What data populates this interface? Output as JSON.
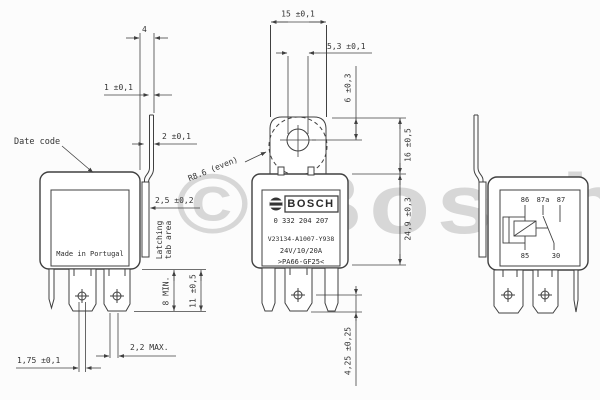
{
  "watermark": "© Bosch",
  "views": {
    "left": {
      "made_in": "Made in Portugal",
      "dims": {
        "tab_width": "4",
        "tab_thickness": "1 ±0,1",
        "tab_step": "2 ±0,1",
        "date_code_label": "Date code",
        "latch_depth": "2,5 ±0,2",
        "latching_line1": "Latching",
        "latching_line2": "tab area",
        "contact_min": "8 MIN.",
        "terminal_length": "11 ±0,5",
        "blade_max": "2,2 MAX.",
        "blade_thickness": "1,75 ±0,1"
      }
    },
    "front": {
      "dims": {
        "bracket_width": "15 ±0,1",
        "hole_diameter": "5,3 ±0,1",
        "hole_offset": "6 ±0,3",
        "bracket_height": "16 ±0,5",
        "body_height": "24,9 ±0,3",
        "bracket_radius": "R8.6 (even)",
        "hole_to_tip": "4,25 ±0,25"
      },
      "label": {
        "brand": "BOSCH",
        "part_number": "0 332 204 207",
        "type_code": "V23134-A1007-Y938",
        "rating": "24V/10/20A",
        "material": ">PA66-GF25<"
      }
    },
    "right": {
      "circuit_pins": {
        "p86": "86",
        "p87a": "87a",
        "p87": "87",
        "p85": "85",
        "p30": "30"
      }
    }
  }
}
